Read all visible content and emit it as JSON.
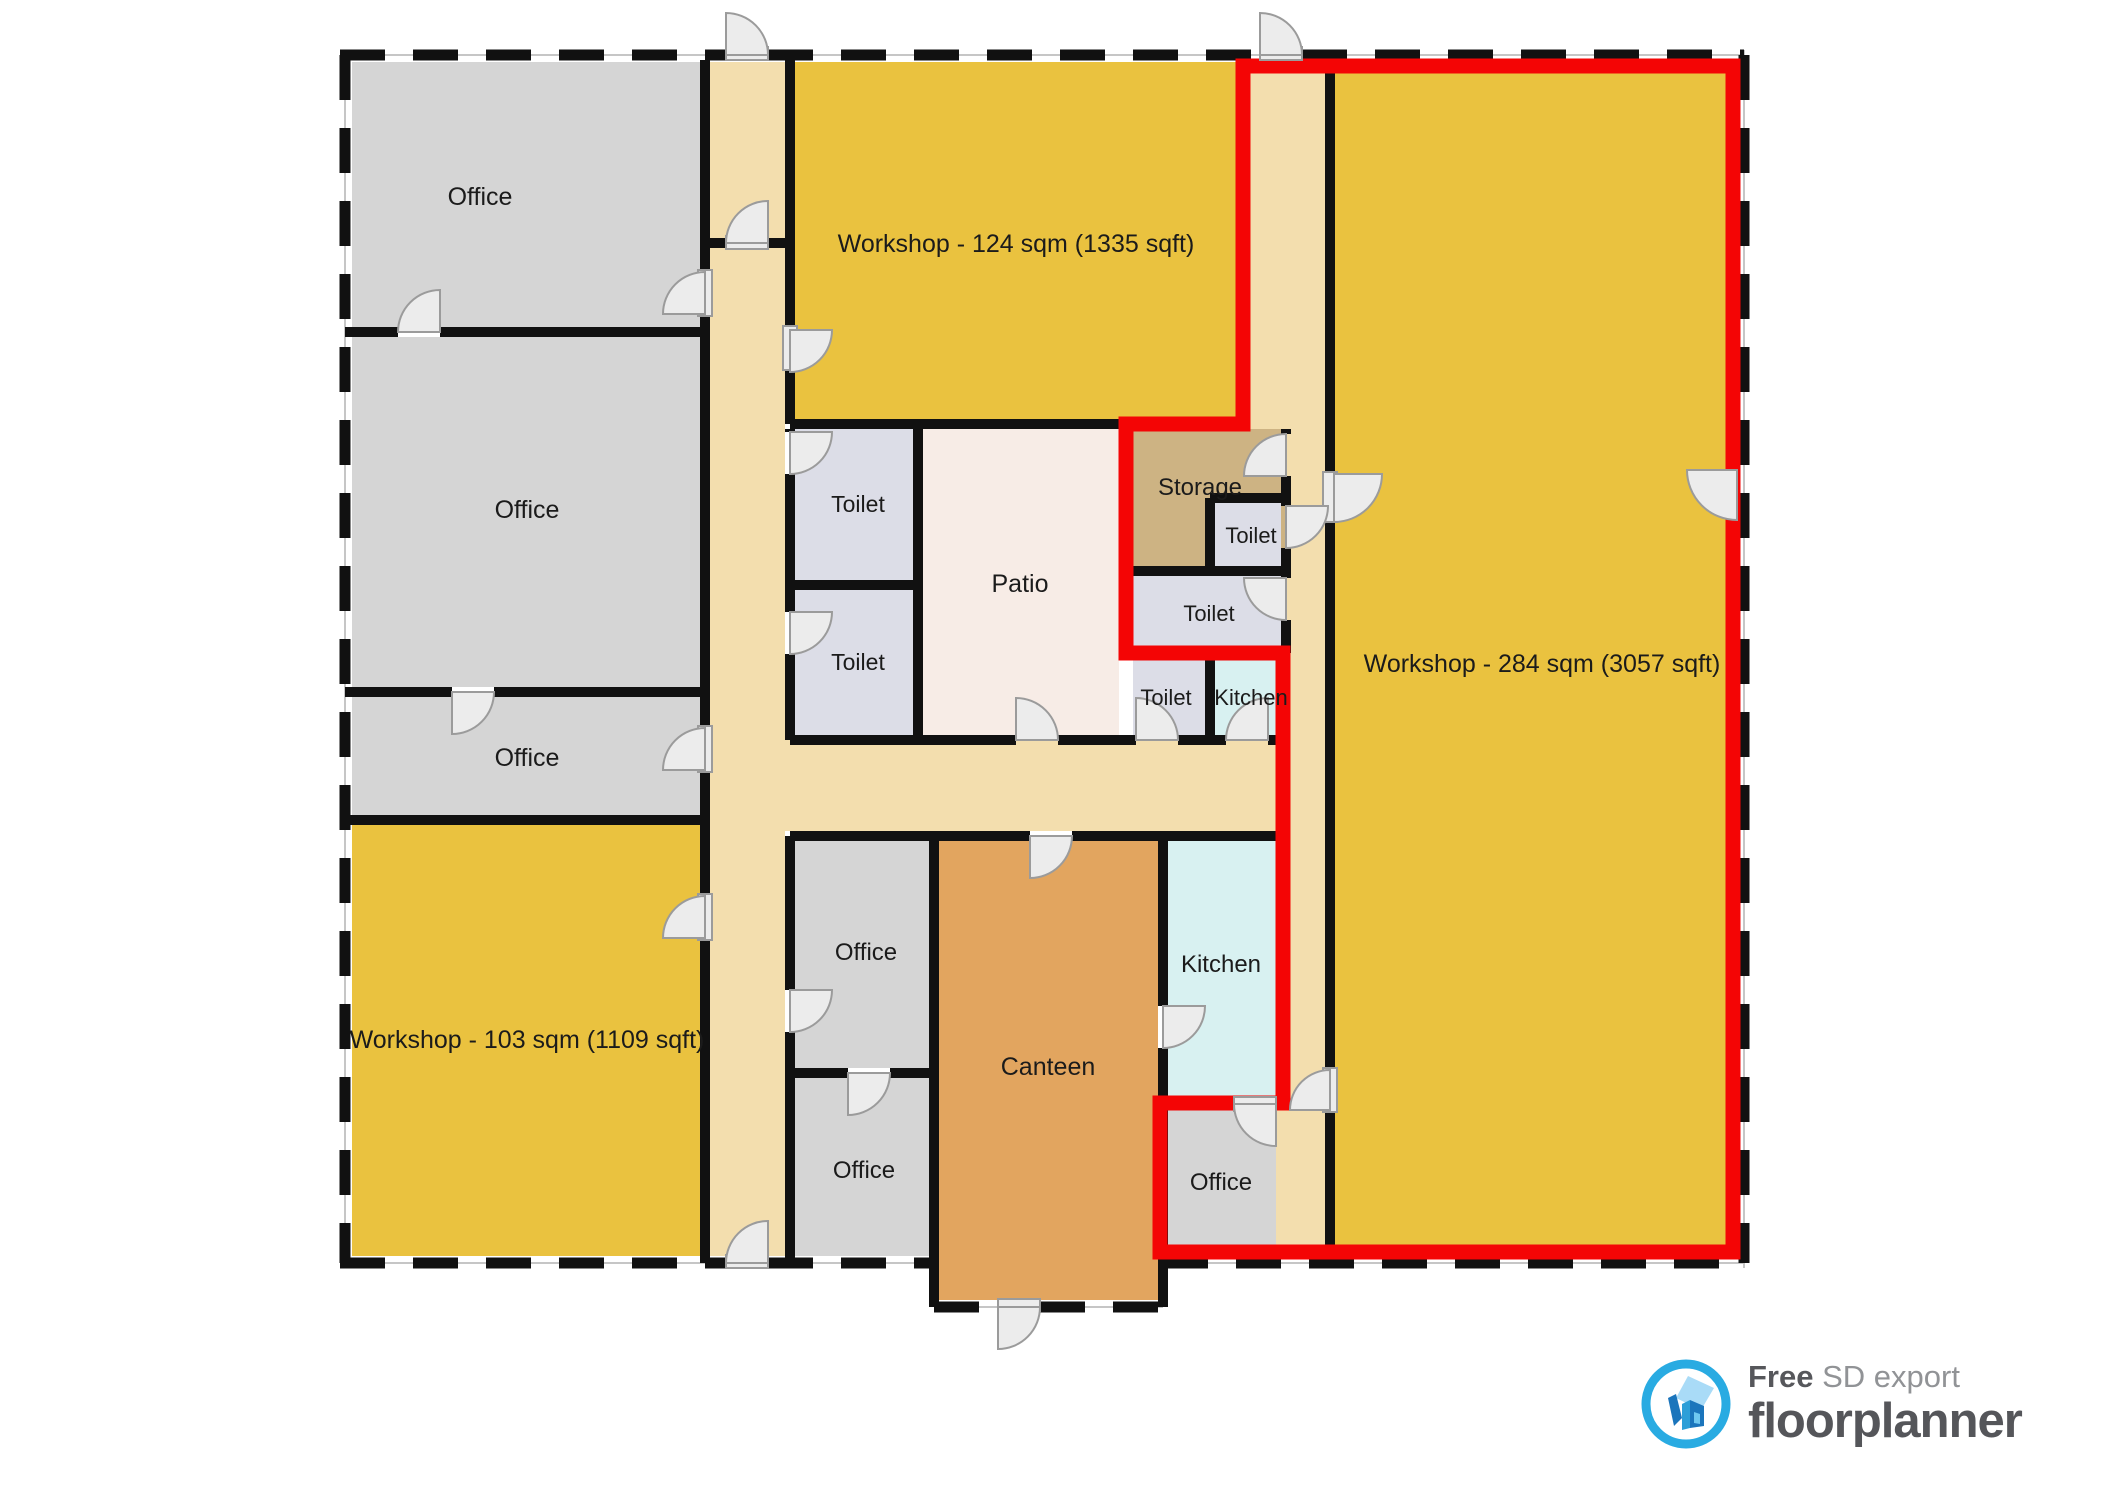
{
  "plan": {
    "palette": {
      "yellow": "#EAC23F",
      "gray": "#D5D5D5",
      "corridor": "#F3DEAE",
      "patio": "#F7ECE6",
      "toilet": "#DCDDE7",
      "storage": "#CDB383",
      "kitchen": "#D8F1F1",
      "canteen": "#E2A55F"
    },
    "wall_color": "#111111",
    "red_outline": "#F40505",
    "rooms": [
      {
        "id": "corridor-left",
        "label": "",
        "x": 710,
        "y": 60,
        "w": 75,
        "h": 1198,
        "color": "corridor",
        "lx": 0,
        "ly": 0
      },
      {
        "id": "corridor-right",
        "label": "",
        "x": 1250,
        "y": 60,
        "w": 75,
        "h": 1198,
        "color": "corridor",
        "lx": 0,
        "ly": 0
      },
      {
        "id": "corridor-middle",
        "label": "",
        "x": 710,
        "y": 735,
        "w": 566,
        "h": 96,
        "color": "corridor",
        "lx": 0,
        "ly": 0
      },
      {
        "id": "office-1",
        "label": "Office",
        "x": 350,
        "y": 60,
        "w": 350,
        "h": 267,
        "color": "gray",
        "lx": 480,
        "ly": 205,
        "fs": 25
      },
      {
        "id": "office-2",
        "label": "Office",
        "x": 350,
        "y": 337,
        "w": 350,
        "h": 350,
        "color": "gray",
        "lx": 527,
        "ly": 518,
        "fs": 25
      },
      {
        "id": "office-3",
        "label": "Office",
        "x": 350,
        "y": 697,
        "w": 350,
        "h": 118,
        "color": "gray",
        "lx": 527,
        "ly": 766,
        "fs": 25
      },
      {
        "id": "workshop-103",
        "label": "Workshop - 103 sqm (1109 sqft)",
        "x": 350,
        "y": 825,
        "w": 350,
        "h": 433,
        "color": "yellow",
        "lx": 527,
        "ly": 1048,
        "fs": 25
      },
      {
        "id": "workshop-124",
        "label": "Workshop - 124 sqm (1335 sqft)",
        "x": 795,
        "y": 60,
        "w": 443,
        "h": 359,
        "color": "yellow",
        "lx": 1016,
        "ly": 252,
        "fs": 25
      },
      {
        "id": "workshop-284",
        "label": "Workshop - 284 sqm (3057 sqft)",
        "x": 1335,
        "y": 60,
        "w": 398,
        "h": 1198,
        "color": "yellow",
        "lx": 1542,
        "ly": 672,
        "fs": 25
      },
      {
        "id": "toilet-1",
        "label": "Toilet",
        "x": 795,
        "y": 429,
        "w": 118,
        "h": 151,
        "color": "toilet",
        "lx": 858,
        "ly": 512,
        "fs": 23
      },
      {
        "id": "toilet-2",
        "label": "Toilet",
        "x": 795,
        "y": 590,
        "w": 118,
        "h": 145,
        "color": "toilet",
        "lx": 858,
        "ly": 670,
        "fs": 23
      },
      {
        "id": "patio",
        "label": "Patio",
        "x": 923,
        "y": 429,
        "w": 196,
        "h": 306,
        "color": "patio",
        "lx": 1020,
        "ly": 592,
        "fs": 25
      },
      {
        "id": "storage",
        "label": "Storage",
        "x": 1133,
        "y": 429,
        "w": 153,
        "h": 137,
        "color": "storage",
        "lx": 1200,
        "ly": 495,
        "fs": 24
      },
      {
        "id": "toilet-3",
        "label": "Toilet",
        "x": 1215,
        "y": 503,
        "w": 66,
        "h": 63,
        "color": "toilet",
        "lx": 1251,
        "ly": 543,
        "fs": 22
      },
      {
        "id": "toilet-4",
        "label": "Toilet",
        "x": 1133,
        "y": 576,
        "w": 148,
        "h": 72,
        "color": "toilet",
        "lx": 1209,
        "ly": 621,
        "fs": 22
      },
      {
        "id": "toilet-5",
        "label": "Toilet",
        "x": 1133,
        "y": 660,
        "w": 72,
        "h": 75,
        "color": "toilet",
        "lx": 1166,
        "ly": 705,
        "fs": 22
      },
      {
        "id": "kitchen-small",
        "label": "Kitchen",
        "x": 1215,
        "y": 660,
        "w": 61,
        "h": 75,
        "color": "kitchen",
        "lx": 1251,
        "ly": 705,
        "fs": 22
      },
      {
        "id": "office-mid-top",
        "label": "Office",
        "x": 795,
        "y": 841,
        "w": 134,
        "h": 227,
        "color": "gray",
        "lx": 866,
        "ly": 960,
        "fs": 24
      },
      {
        "id": "office-mid-bottom",
        "label": "Office",
        "x": 795,
        "y": 1078,
        "w": 134,
        "h": 180,
        "color": "gray",
        "lx": 864,
        "ly": 1178,
        "fs": 24
      },
      {
        "id": "canteen",
        "label": "Canteen",
        "x": 939,
        "y": 841,
        "w": 219,
        "h": 461,
        "color": "canteen",
        "lx": 1048,
        "ly": 1075,
        "fs": 25
      },
      {
        "id": "kitchen-big",
        "label": "Kitchen",
        "x": 1168,
        "y": 841,
        "w": 108,
        "h": 258,
        "color": "kitchen",
        "lx": 1221,
        "ly": 972,
        "fs": 24
      },
      {
        "id": "office-bottom-right",
        "label": "Office",
        "x": 1168,
        "y": 1110,
        "w": 108,
        "h": 148,
        "color": "gray",
        "lx": 1221,
        "ly": 1190,
        "fs": 24
      }
    ]
  },
  "footer": {
    "free_label": "Free",
    "export_label": "SD export",
    "brand": "floorplanner",
    "brand_blue": "#29ABE2"
  }
}
